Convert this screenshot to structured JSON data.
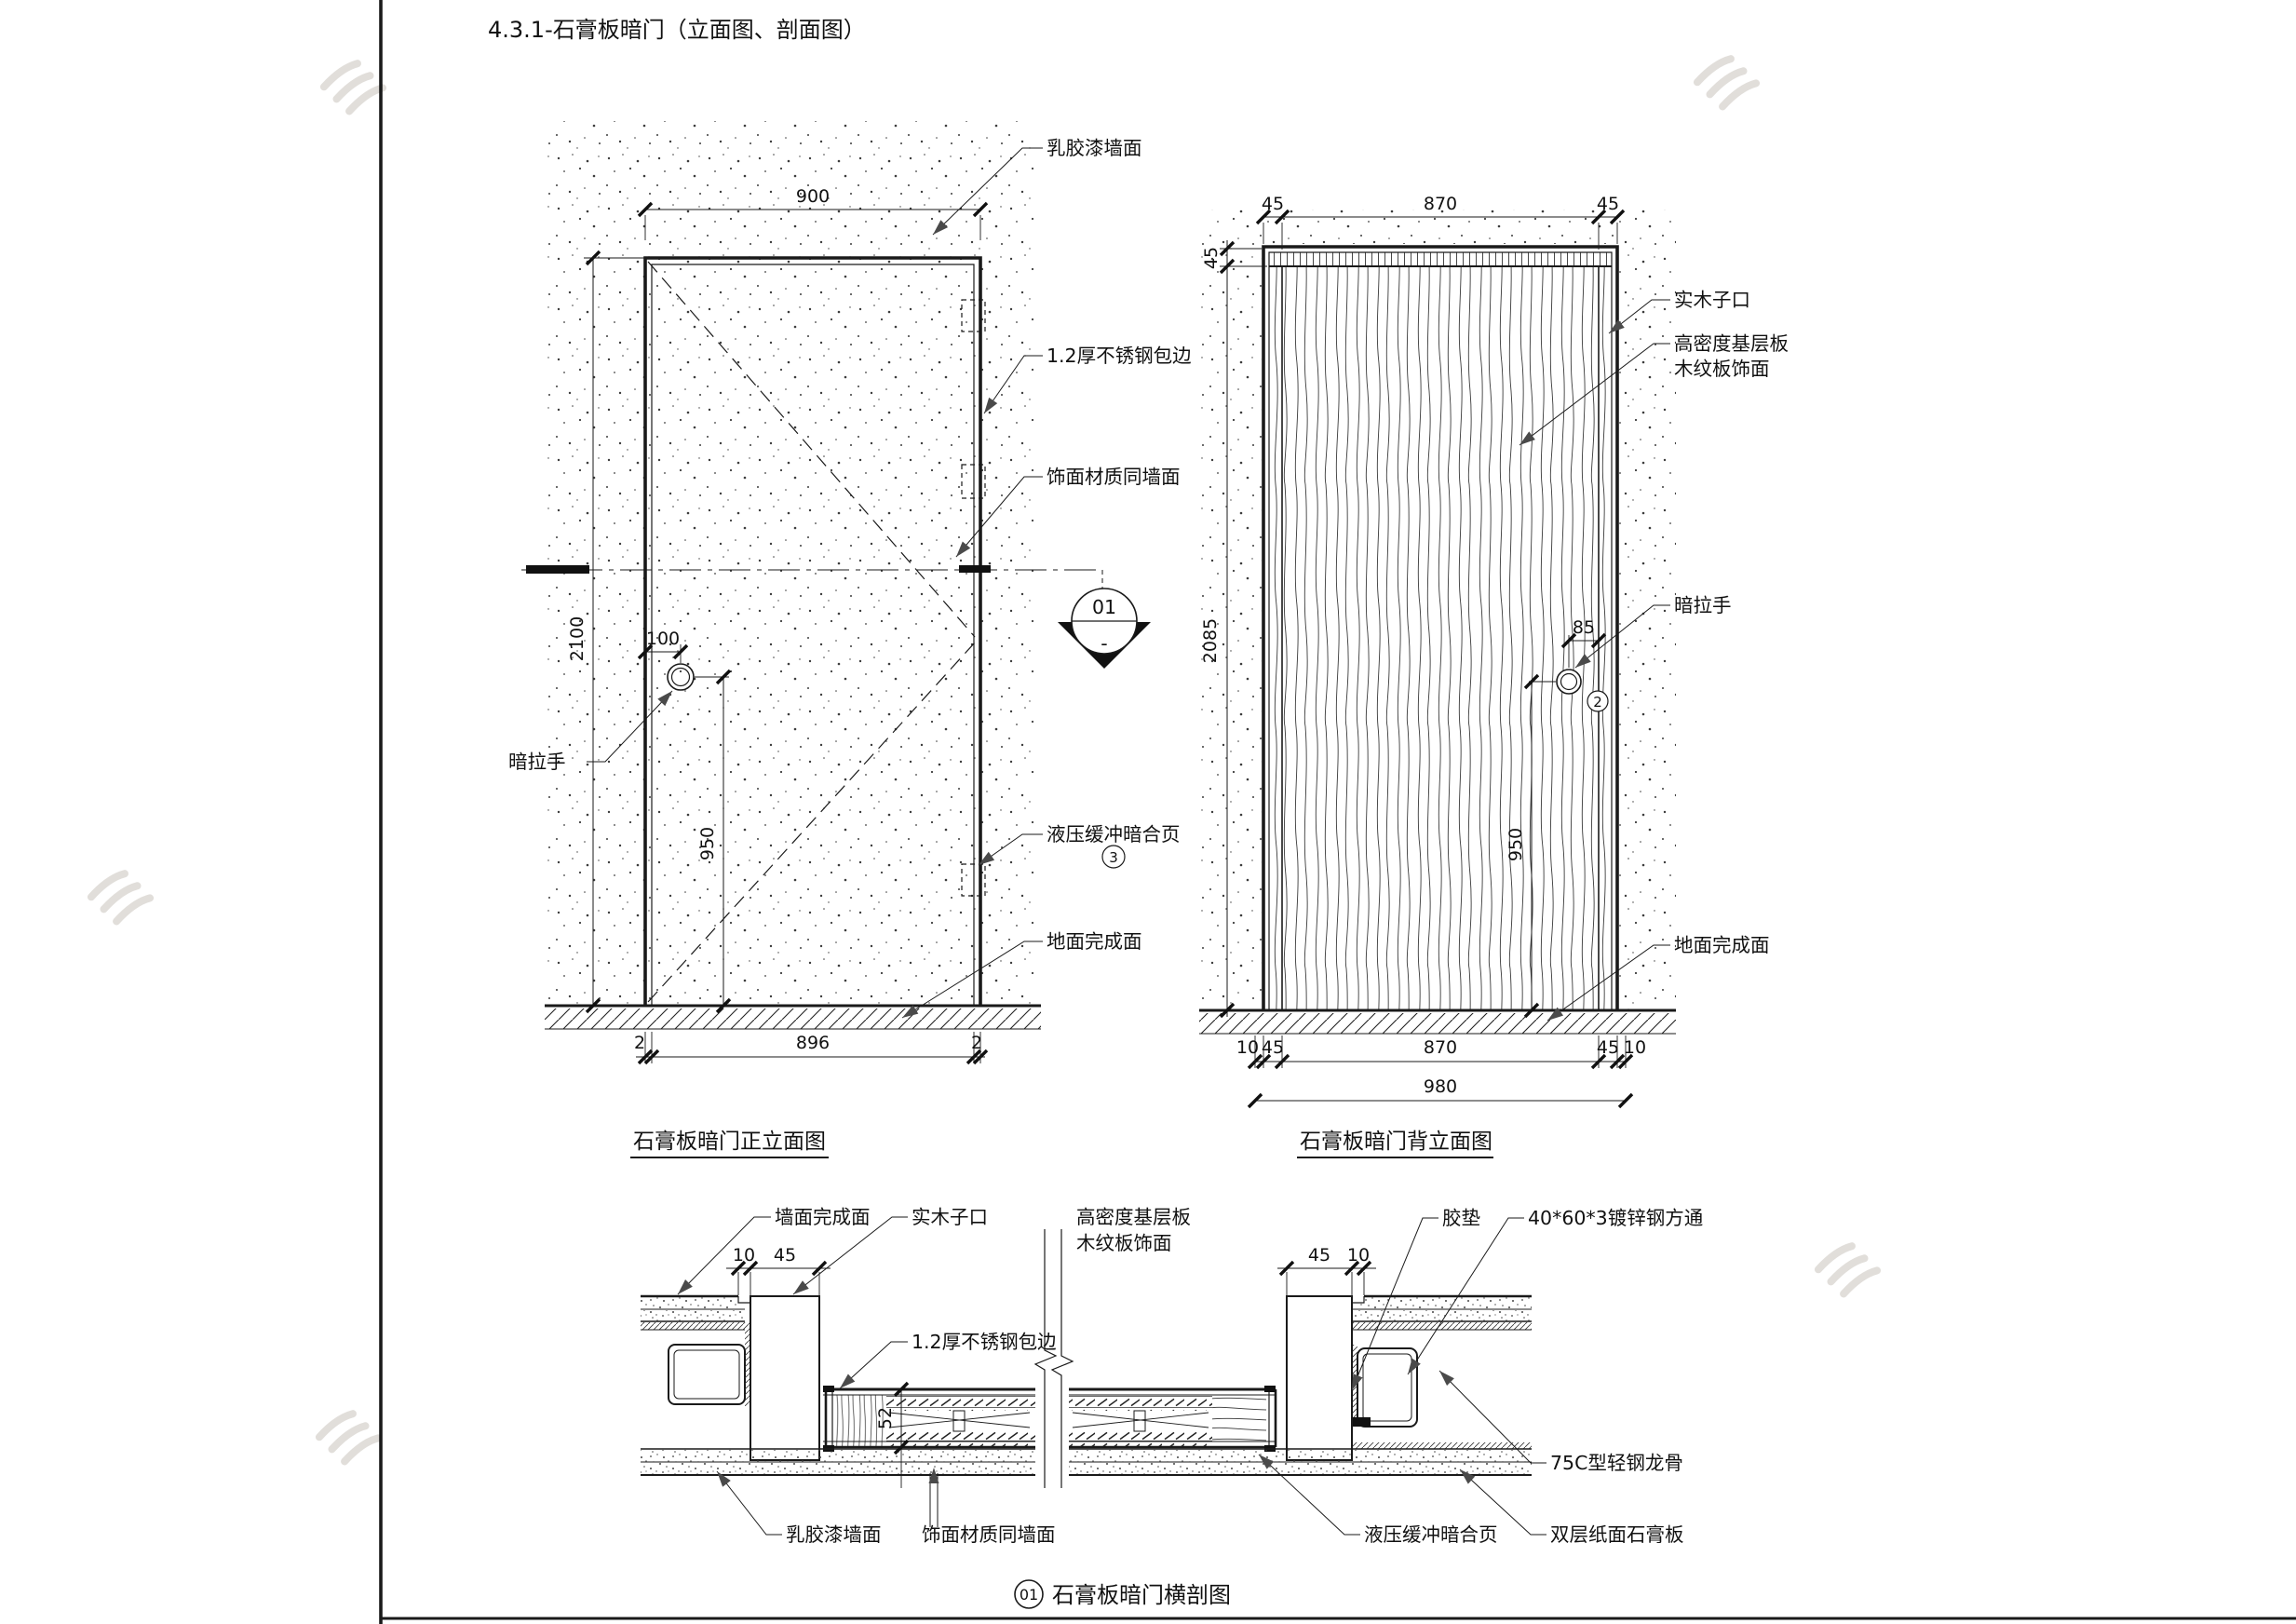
{
  "header": {
    "title": "4.3.1-石膏板暗门（立面图、剖面图）"
  },
  "front_elevation": {
    "title": "石膏板暗门正立面图",
    "marker": {
      "no": "01",
      "sheet": "-"
    },
    "labels": {
      "wall_paint": "乳胶漆墙面",
      "steel_edge": "1.2厚不锈钢包边",
      "face_same": "饰面材质同墙面",
      "hinge": "液压缓冲暗合页",
      "hinge_no": "3",
      "floor": "地面完成面",
      "handle": "暗拉手"
    },
    "dims": {
      "width": "900",
      "height": "2100",
      "handle_x": "100",
      "handle_y": "950",
      "bottom_left": "2",
      "bottom_mid": "896",
      "bottom_right": "2"
    }
  },
  "back_elevation": {
    "title": "石膏板暗门背立面图",
    "labels": {
      "rabbet": "实木子口",
      "board1": "高密度基层板",
      "board2": "木纹板饰面",
      "handle": "暗拉手",
      "handle_no": "2",
      "floor": "地面完成面"
    },
    "dims": {
      "top": [
        "45",
        "870",
        "45"
      ],
      "lintel": "45",
      "height": "2085",
      "handle_x": "85",
      "handle_y": "950",
      "bottom": [
        "10",
        "45",
        "870",
        "45",
        "10"
      ],
      "overall": "980"
    }
  },
  "section": {
    "marker_no": "01",
    "title": "石膏板暗门横剖图",
    "labels": {
      "wall_finish": "墙面完成面",
      "rabbet": "实木子口",
      "board1": "高密度基层板",
      "board2": "木纹板饰面",
      "steel_edge": "1.2厚不锈钢包边",
      "pad": "胶垫",
      "tube": "40*60*3镀锌钢方通",
      "paint": "乳胶漆墙面",
      "face_same": "饰面材质同墙面",
      "hinge": "液压缓冲暗合页",
      "gypsum": "双层纸面石膏板",
      "stud": "75C型轻钢龙骨"
    },
    "dims": {
      "left": [
        "10",
        "45"
      ],
      "right": [
        "45",
        "10"
      ],
      "leaf": "52"
    }
  }
}
